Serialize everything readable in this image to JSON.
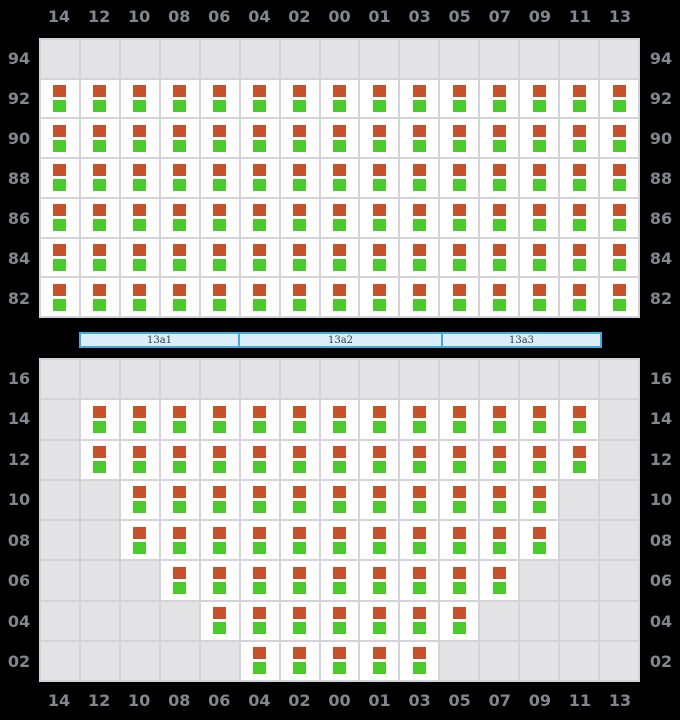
{
  "colors": {
    "background": "#000000",
    "axis_label": "#82868e",
    "gridline": "#d4d4d8",
    "empty_cell": "#e4e4e6",
    "filled_cell": "#ffffff",
    "marker_top": "#c5522b",
    "marker_bottom": "#4bcb2b",
    "hatch_fill": "#d9eef9",
    "hatch_border": "#44aadd",
    "hatch_text": "#3c3c3c"
  },
  "columns": [
    "14",
    "12",
    "10",
    "08",
    "06",
    "04",
    "02",
    "00",
    "01",
    "03",
    "05",
    "07",
    "09",
    "11",
    "13"
  ],
  "deck_section": {
    "rows": [
      {
        "label": "94",
        "occupied_columns": []
      },
      {
        "label": "92",
        "occupied_columns": [
          "14",
          "12",
          "10",
          "08",
          "06",
          "04",
          "02",
          "00",
          "01",
          "03",
          "05",
          "07",
          "09",
          "11",
          "13"
        ]
      },
      {
        "label": "90",
        "occupied_columns": [
          "14",
          "12",
          "10",
          "08",
          "06",
          "04",
          "02",
          "00",
          "01",
          "03",
          "05",
          "07",
          "09",
          "11",
          "13"
        ]
      },
      {
        "label": "88",
        "occupied_columns": [
          "14",
          "12",
          "10",
          "08",
          "06",
          "04",
          "02",
          "00",
          "01",
          "03",
          "05",
          "07",
          "09",
          "11",
          "13"
        ]
      },
      {
        "label": "86",
        "occupied_columns": [
          "14",
          "12",
          "10",
          "08",
          "06",
          "04",
          "02",
          "00",
          "01",
          "03",
          "05",
          "07",
          "09",
          "11",
          "13"
        ]
      },
      {
        "label": "84",
        "occupied_columns": [
          "14",
          "12",
          "10",
          "08",
          "06",
          "04",
          "02",
          "00",
          "01",
          "03",
          "05",
          "07",
          "09",
          "11",
          "13"
        ]
      },
      {
        "label": "82",
        "occupied_columns": [
          "14",
          "12",
          "10",
          "08",
          "06",
          "04",
          "02",
          "00",
          "01",
          "03",
          "05",
          "07",
          "09",
          "11",
          "13"
        ]
      }
    ]
  },
  "hold_section": {
    "rows": [
      {
        "label": "16",
        "occupied_columns": []
      },
      {
        "label": "14",
        "occupied_columns": [
          "12",
          "10",
          "08",
          "06",
          "04",
          "02",
          "00",
          "01",
          "03",
          "05",
          "07",
          "09",
          "11"
        ]
      },
      {
        "label": "12",
        "occupied_columns": [
          "12",
          "10",
          "08",
          "06",
          "04",
          "02",
          "00",
          "01",
          "03",
          "05",
          "07",
          "09",
          "11"
        ]
      },
      {
        "label": "10",
        "occupied_columns": [
          "10",
          "08",
          "06",
          "04",
          "02",
          "00",
          "01",
          "03",
          "05",
          "07",
          "09"
        ]
      },
      {
        "label": "08",
        "occupied_columns": [
          "10",
          "08",
          "06",
          "04",
          "02",
          "00",
          "01",
          "03",
          "05",
          "07",
          "09"
        ]
      },
      {
        "label": "06",
        "occupied_columns": [
          "08",
          "06",
          "04",
          "02",
          "00",
          "01",
          "03",
          "05",
          "07"
        ]
      },
      {
        "label": "04",
        "occupied_columns": [
          "06",
          "04",
          "02",
          "00",
          "01",
          "03",
          "05"
        ]
      },
      {
        "label": "02",
        "occupied_columns": [
          "04",
          "02",
          "00",
          "01",
          "03"
        ]
      }
    ]
  },
  "cell_markers": [
    "marker_top",
    "marker_bottom"
  ],
  "hatch_covers": [
    {
      "label": "13a1"
    },
    {
      "label": "13a2"
    },
    {
      "label": "13a3"
    }
  ]
}
